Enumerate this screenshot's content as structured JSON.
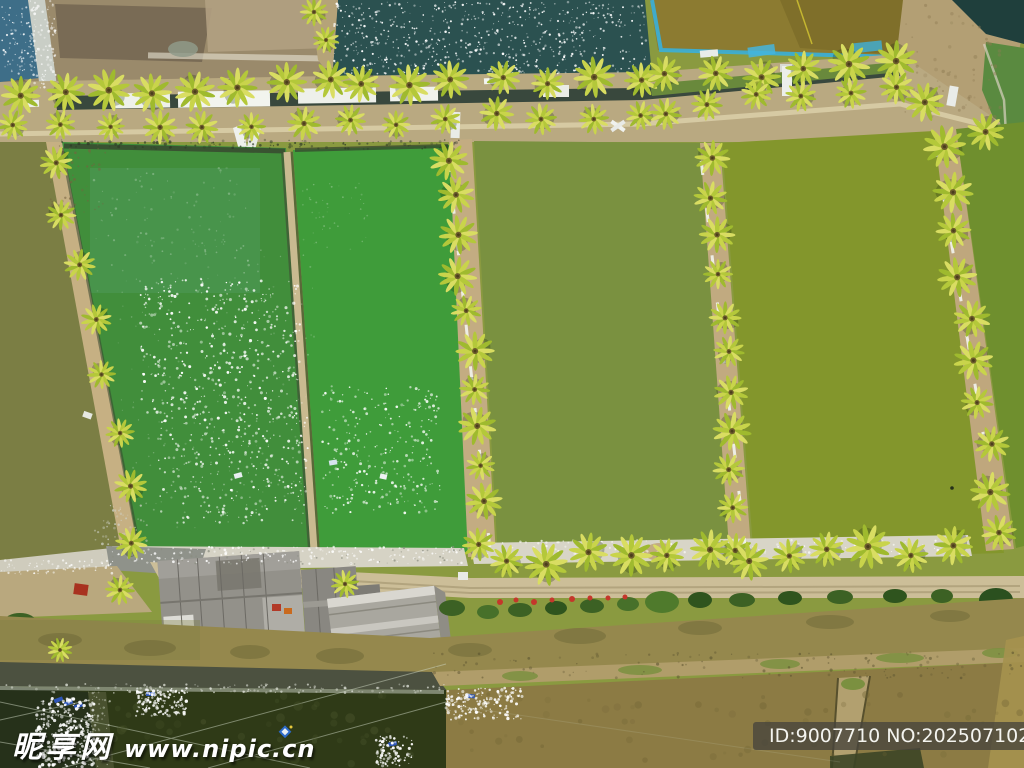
{
  "watermarks": {
    "site_name": "昵享网",
    "site_url": "www.nipic.cn",
    "id_text": "ID:9007710 NO:20250710205937957102"
  },
  "palette": {
    "green_pond_1": "#418e3b",
    "green_pond_2": "#3f9c3a",
    "olive_pond_3": "#7a9140",
    "olive_pond_4": "#83962c",
    "olive_pond_right": "#6f8f2e",
    "olive_pond_left_edge": "#7b7e44",
    "teal_water": "#2b5150",
    "brown_pond_top_right": "#8c7b31",
    "dark_pond_bottom_left": "#2f3a17",
    "murky_brown_pond": "#8c7b44",
    "canal_water": "#95884d",
    "dirt_field": "#9a8a6b",
    "embankment_tan": "#c3ac82",
    "road_tan": "#c6b890",
    "palm_leaf_light": "#d9dd62",
    "palm_leaf_mid": "#c9d44b",
    "palm_leaf_dark": "#9fba2e",
    "blue_tarp": "#38b0da",
    "roof_gray": "#94928b",
    "sparkle_white": "#ffffff",
    "watermark_white": "#ffffff"
  }
}
